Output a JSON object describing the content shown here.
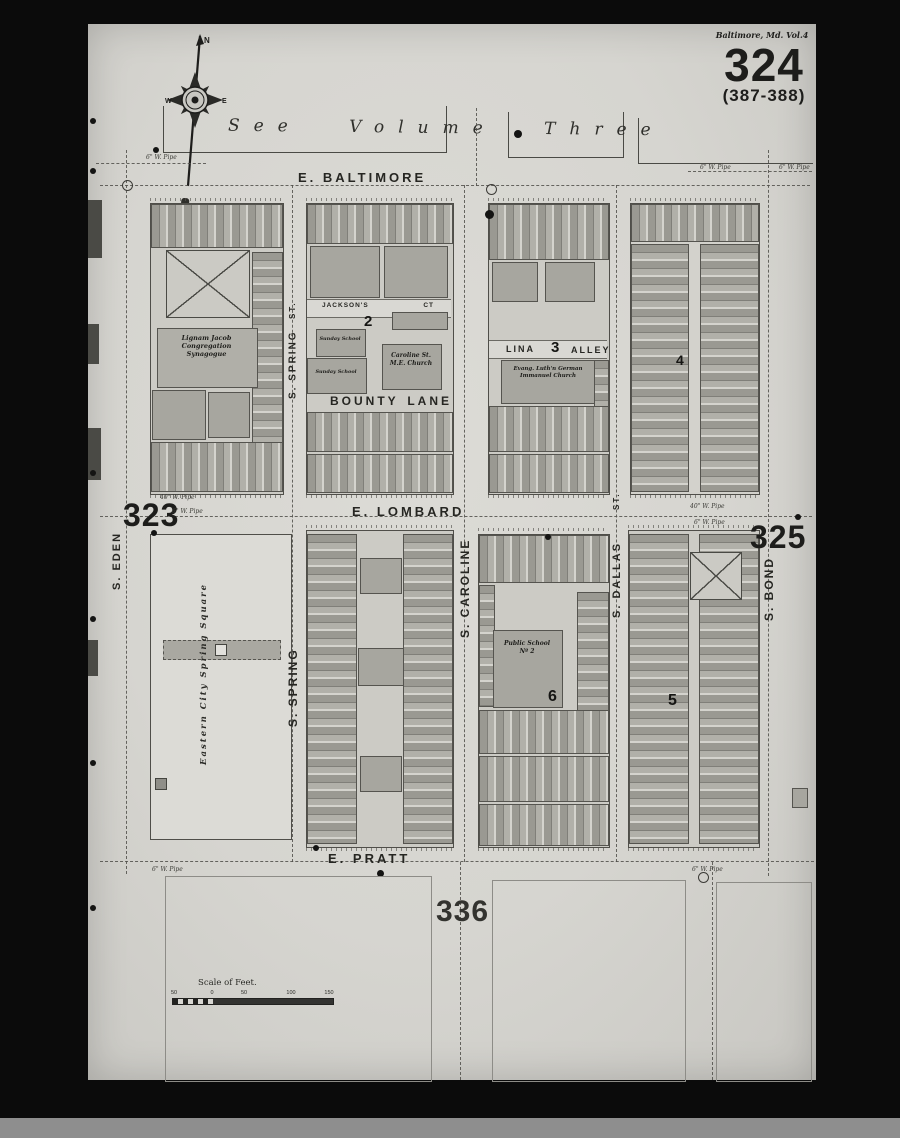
{
  "sheet": {
    "header_small": "Baltimore, Md. Vol.4",
    "page_number": "324",
    "page_range": "(387-388)",
    "see_volume": "See Volume Three",
    "adjacent_left": "323",
    "adjacent_right": "325",
    "adjacent_bottom": "336"
  },
  "compass": {
    "north": "N",
    "east": "E",
    "west": "W"
  },
  "streets": {
    "e_baltimore": "E. BALTIMORE",
    "e_lombard": "E. LOMBARD",
    "e_pratt": "E. PRATT",
    "s_eden": "S. EDEN",
    "s_spring_st": "ST.",
    "s_spring_upper": "S. SPRING",
    "s_spring_lower": "S. SPRING",
    "s_caroline": "S. CAROLINE",
    "s_dallas_st": "ST.",
    "s_dallas": "S. DALLAS",
    "s_bond": "S. BOND",
    "jacksons": "JACKSON'S",
    "jacksons_ct": "CT",
    "bounty": "BOUNTY",
    "lane": "LANE",
    "lina": "LINA",
    "alley": "ALLEY"
  },
  "block_numbers": {
    "two": "2",
    "three": "3",
    "four": "4",
    "five": "5",
    "six": "6"
  },
  "places": {
    "synagogue_l1": "Lignam Jacob",
    "synagogue_l2": "Congregation",
    "synagogue_l3": "Synagogue",
    "sunday_school": "Sunday School",
    "caroline_l1": "Caroline St.",
    "caroline_l2": "M.E. Church",
    "immanuel_l1": "Evang. Luth'n German",
    "immanuel_l2": "Immanuel Church",
    "school_l1": "Public School",
    "school_l2": "Nº 2",
    "park": "Eastern City Spring Square"
  },
  "annotations": {
    "pipe_6": "6\" W. Pipe",
    "pipe_40": "40\" W. Pipe"
  },
  "scale": {
    "title": "Scale of Feet.",
    "t_a": "50",
    "t_b": "0",
    "t_c": "50",
    "t_d": "100",
    "t_e": "150"
  }
}
